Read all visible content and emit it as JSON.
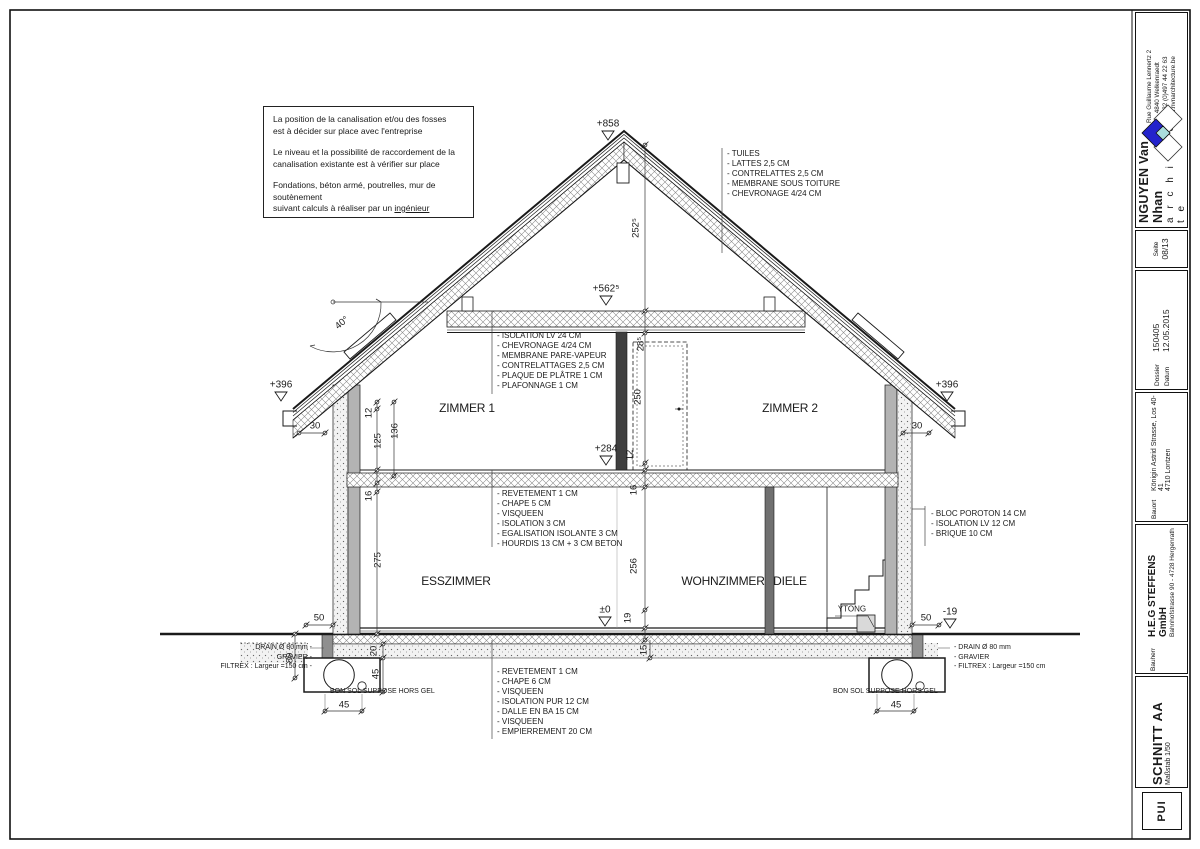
{
  "note_box": {
    "l1": "La position de la canalisation et/ou des fosses",
    "l2": "est à décider sur place avec l'entreprise",
    "l3": "Le niveau et la possibilité de raccordement de la",
    "l4": "canalisation existante est à vérifier sur place",
    "l5": "Fondations, béton armé, poutrelles, mur de soutènement",
    "l6_pre": "suivant calculs à réaliser par un ",
    "l6_underlined": "ingénieur"
  },
  "annotations": {
    "roof": [
      "- TUILES",
      "- LATTES 2,5 CM",
      "- CONTRELATTES 2,5 CM",
      "- MEMBRANE SOUS TOITURE",
      "- CHEVRONAGE 4/24 CM"
    ],
    "attic_ceiling": [
      "- ISOLATION LV 24 CM",
      "- CHEVRONAGE 4/24 CM",
      "- MEMBRANE PARE-VAPEUR",
      "- CONTRELATTAGES 2,5 CM",
      "- PLAQUE DE PLÂTRE 1 CM",
      "- PLAFONNAGE 1 CM"
    ],
    "upper_floor": [
      "- REVETEMENT 1 CM",
      "- CHAPE 5 CM",
      "- VISQUEEN",
      "- ISOLATION 3 CM",
      "- EGALISATION ISOLANTE 3 CM",
      "- HOURDIS 13 CM + 3 CM BETON"
    ],
    "ground_floor": [
      "- REVETEMENT 1 CM",
      "- CHAPE 6 CM",
      "- VISQUEEN",
      "- ISOLATION PUR 12 CM",
      "- DALLE EN BA 15 CM",
      "- VISQUEEN",
      "- EMPIERREMENT 20 CM"
    ],
    "wall_right": [
      "- BLOC POROTON 14 CM",
      "- ISOLATION LV 12 CM",
      "- BRIQUE 10 CM"
    ],
    "drain_left": [
      "DRAIN Ø 80 mm -",
      "GRAVIER -",
      "FILTREX : Largeur =150 cm -"
    ],
    "drain_right": [
      "- DRAIN Ø 80 mm",
      "- GRAVIER",
      "- FILTREX : Largeur =150 cm"
    ],
    "soil_left": "BON SOL SUPPOSE HORS GEL",
    "soil_right": "BON SOL SUPPOSE HORS GEL",
    "ytong": "YTONG"
  },
  "rooms": {
    "zimmer1": "ZIMMER 1",
    "zimmer2": "ZIMMER 2",
    "esszimmer": "ESSZIMMER",
    "wohnzimmer": "WOHNZIMMER",
    "diele": "DIELE"
  },
  "levels": {
    "ridge": "+858",
    "attic_ceiling": "+562⁵",
    "attic_floor": "+284",
    "ground": "±0",
    "eave_left": "+396",
    "eave_right": "+396",
    "terrain": "-19"
  },
  "dims": {
    "roof_height": "252⁵",
    "ceiling_thk": "28⁵",
    "door_height": "250",
    "d12_center": "12",
    "floor_thk_center": "16",
    "room_height": "256",
    "d19": "19",
    "d15": "15",
    "left_12": "12",
    "left_125": "125",
    "left_136": "136",
    "left_16": "16",
    "left_275": "275",
    "left_20": "20",
    "left_45": "45",
    "left_80": "80",
    "foot_45_left": "45",
    "foot_45_right": "45",
    "eave_30_left": "30",
    "eave_30_right": "30",
    "d50_left": "50",
    "d50_right": "50",
    "angle": "40°"
  },
  "title_block": {
    "contact": [
      "Rue Guillaume Lennertz 2",
      "B - 4840 Welkenraedt",
      "☎ +32 (0)497 44 22 63",
      "www.nvnarchitecture.be"
    ],
    "architect_name": "NGUYEN Van Nhan",
    "architect_title": "a r c h i t e c t e",
    "seite_label": "Seite",
    "seite_value": "08/13",
    "dossier_label": "Dossier",
    "dossier_value": "150405",
    "datum_label": "Datum",
    "datum_value": "12.05.2015",
    "bauort_label": "Bauort",
    "bauort_line1": "Königin Astrid Strasse, Los 40-41",
    "bauort_line2": "4710 Lontzen",
    "bauherr_label": "Bauherr",
    "bauherr_line1": "H.E.G STEFFENS GmbH",
    "bauherr_line2": "Bahnhofstrasse 90 - 4728 Hergenrath",
    "sheet_title": "SCHNITT AA",
    "sheet_scale": "Maßstab 1/50",
    "logo_text": "PUI"
  },
  "colors": {
    "logo_blue": "#2323cc",
    "logo_teal": "#aadddd",
    "line": "#1a1a1a"
  }
}
